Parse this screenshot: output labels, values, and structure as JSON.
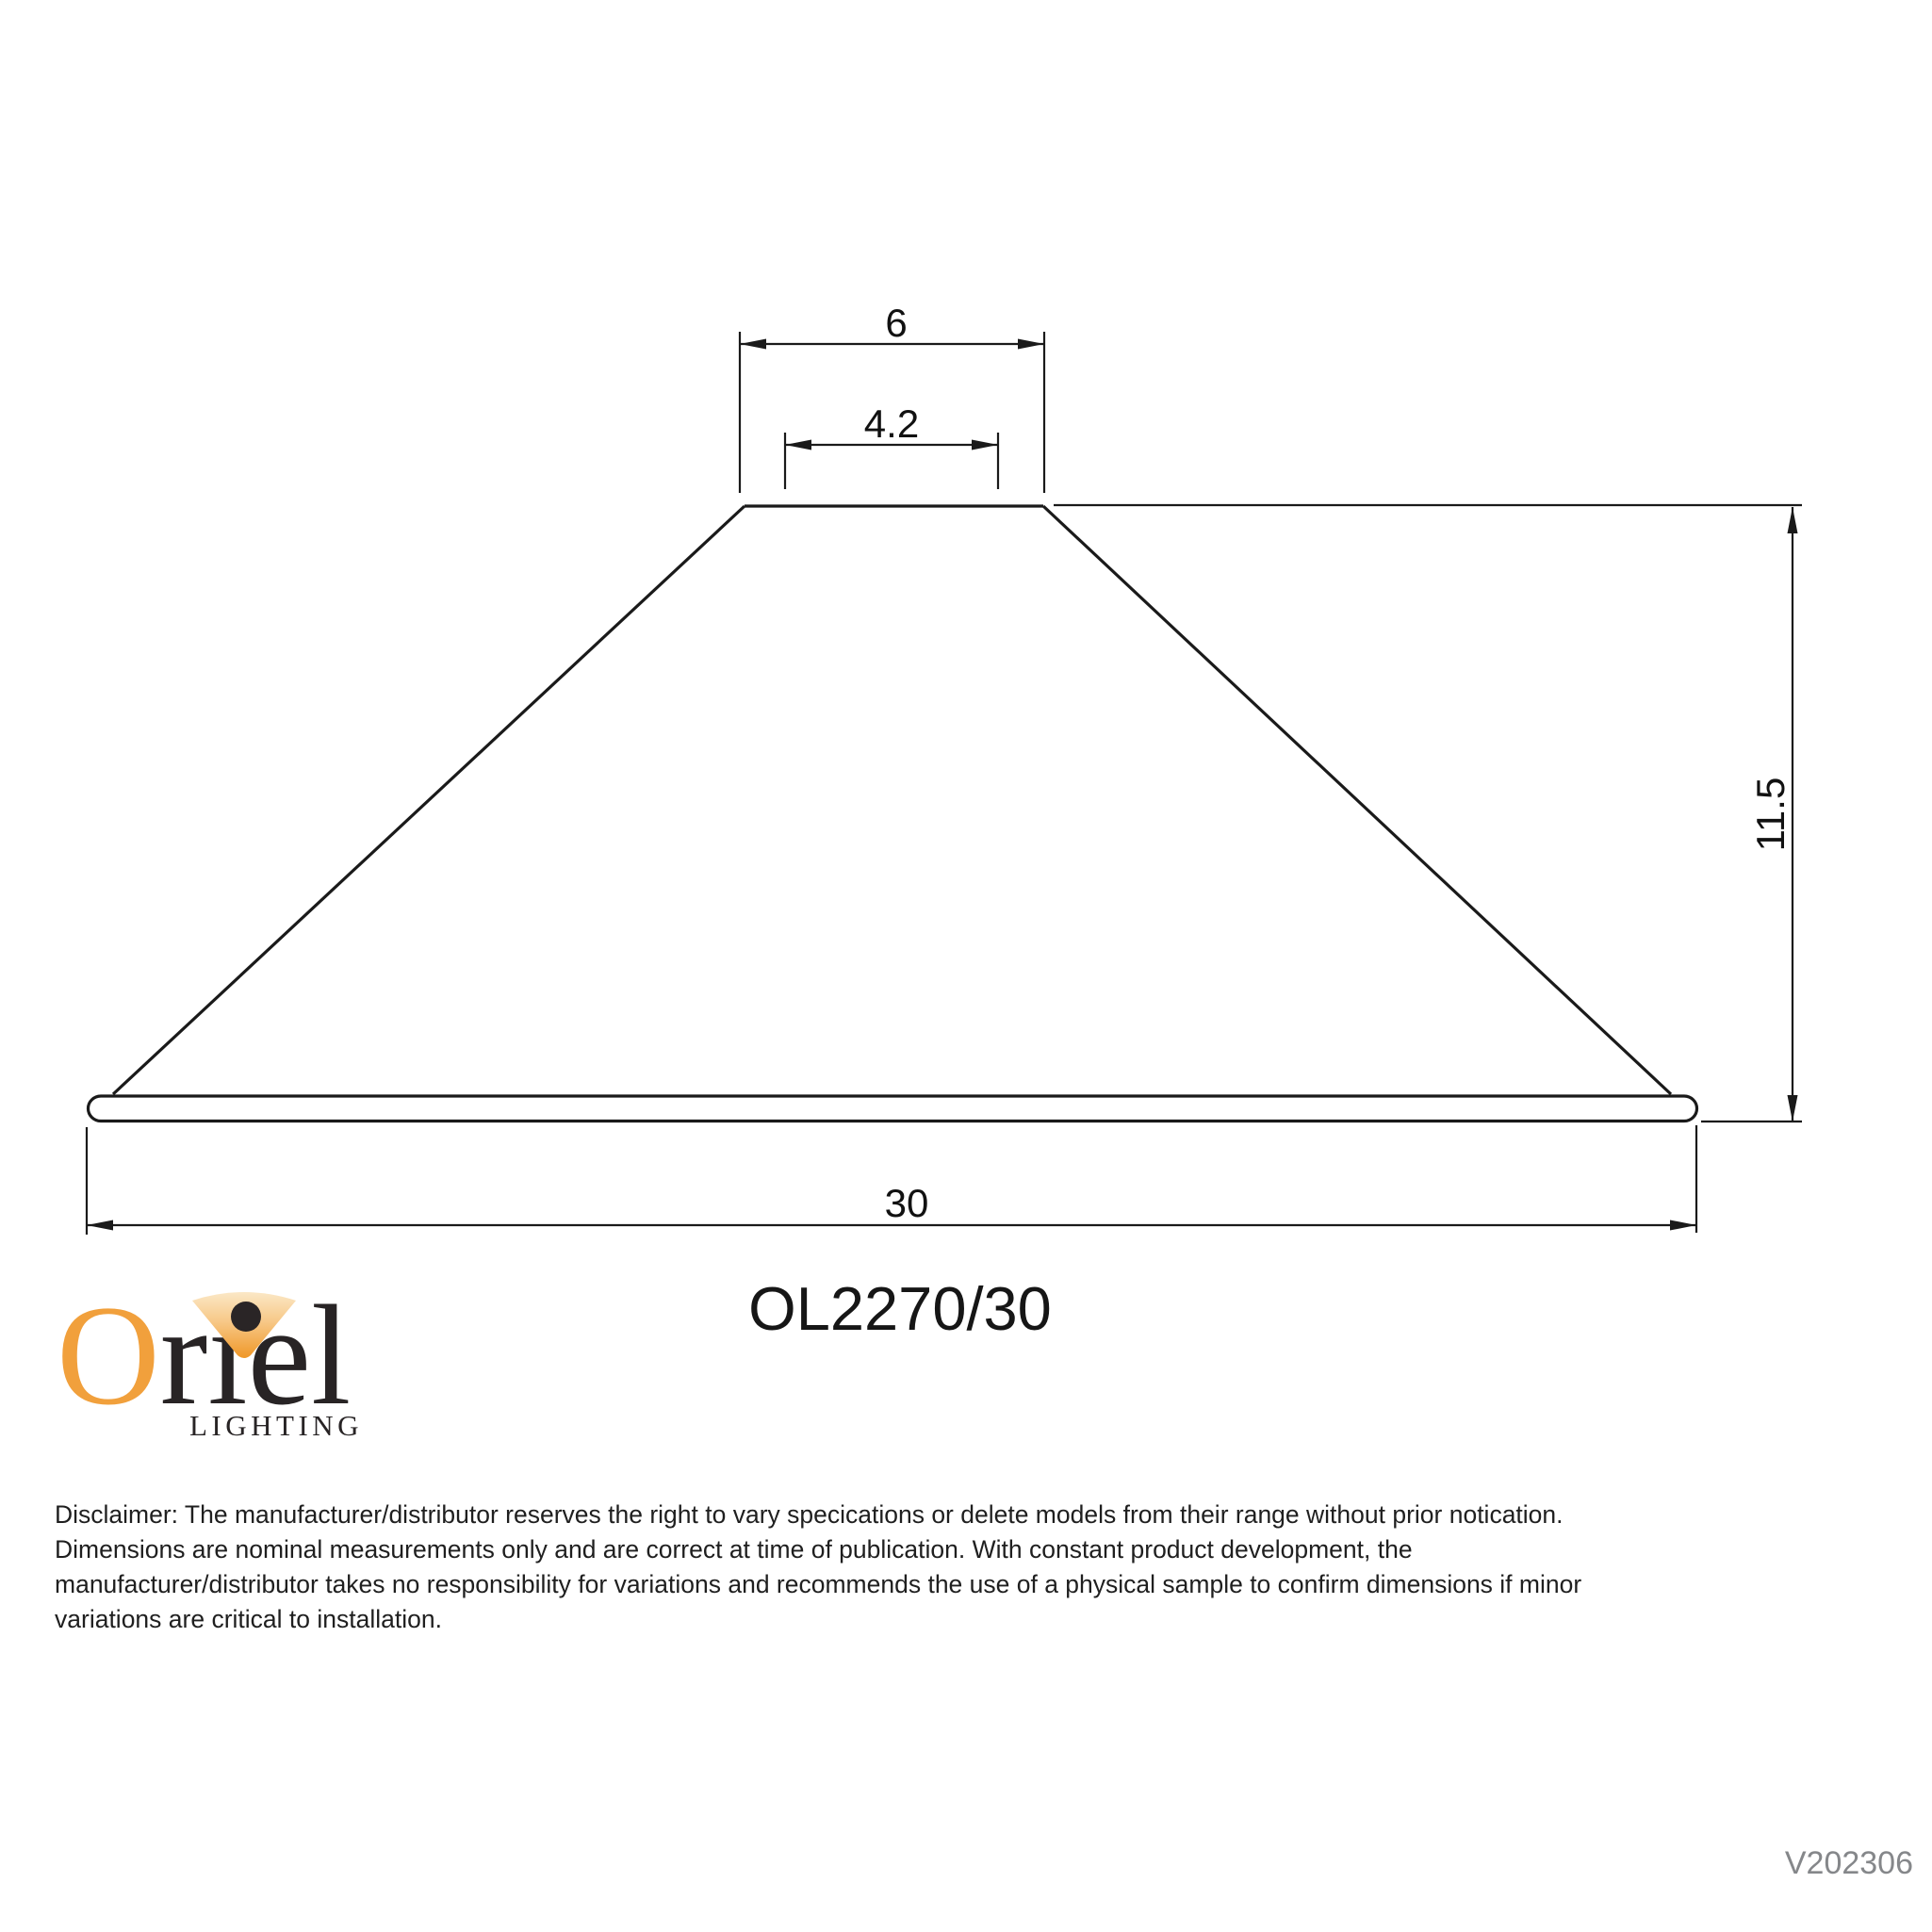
{
  "page": {
    "background": "#ffffff"
  },
  "drawing": {
    "line_color": "#1a1a1a",
    "dimensions": {
      "top_outer": "6",
      "top_inner": "4.2",
      "height": "11.5",
      "bottom_width": "30"
    }
  },
  "model_code": "OL2270/30",
  "logo": {
    "brand_o": "O",
    "brand_rest": "rıel",
    "brand_full": "Oriel",
    "tagline": "LIGHTING",
    "orange_color": "#F1A03C",
    "dark_color": "#282425"
  },
  "disclaimer": {
    "lines": [
      "Disclaimer: The manufacturer/distributor reserves the right to vary specications or delete models from their range without prior notication.",
      "Dimensions are nominal measurements only and are correct at time of publication. With constant product development, the",
      "manufacturer/distributor takes no responsibility for variations and recommends the use of a physical sample to confirm dimensions if minor",
      "variations are critical to installation."
    ]
  },
  "version": "V202306"
}
